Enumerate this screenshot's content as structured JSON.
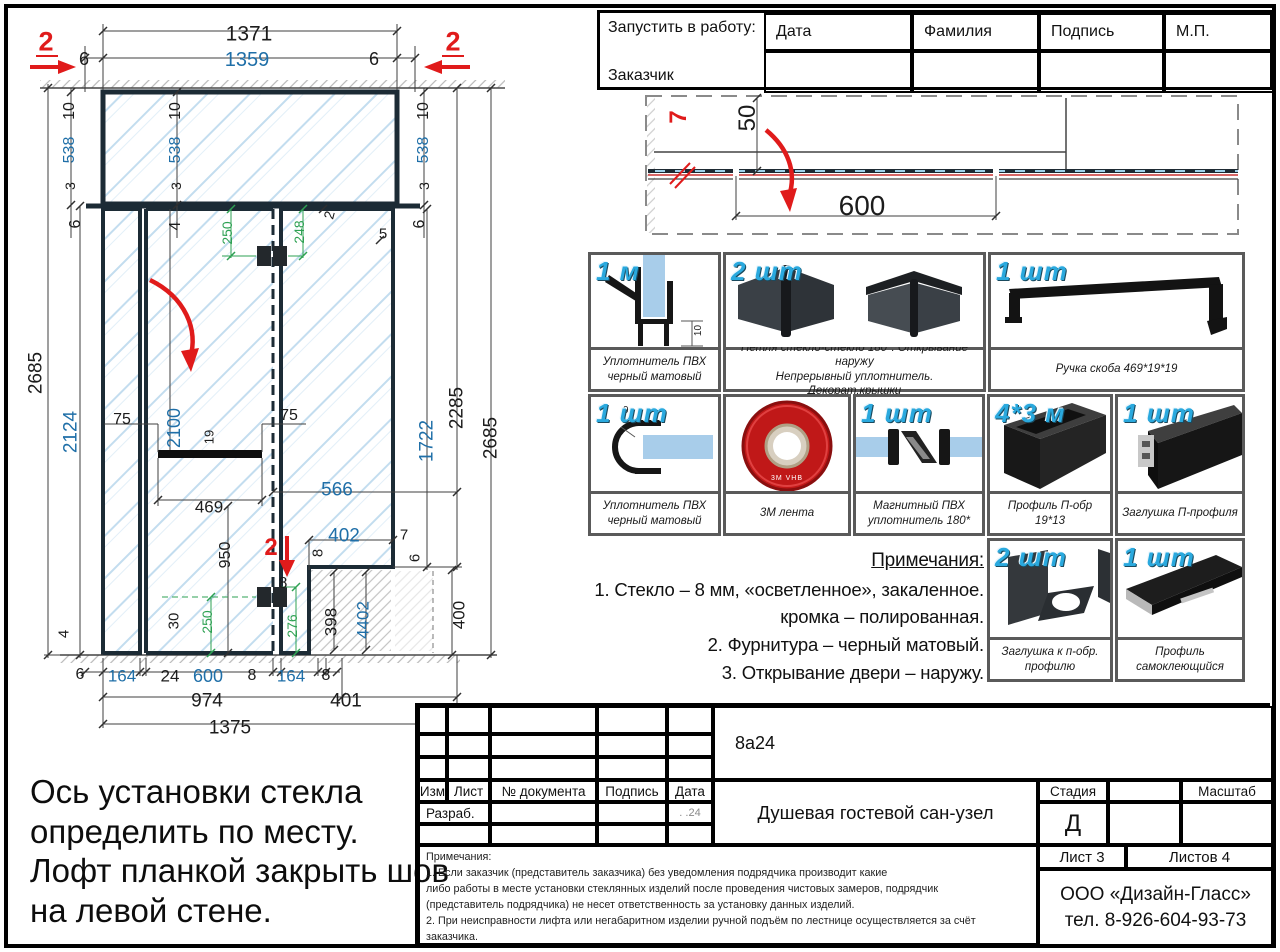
{
  "approval": {
    "request_label": "Запустить в работу:",
    "customer_label": "Заказчик",
    "col_date": "Дата",
    "col_name": "Фамилия",
    "col_sign": "Подпись",
    "col_stamp": "М.П."
  },
  "notes": {
    "title": "Примечания:",
    "line1": "1. Стекло – 8 мм, «осветленное», закаленное.",
    "line2": "кромка – полированная.",
    "line3": "2. Фурнитура – черный матовый.",
    "line4": "3. Открывание двери – наружу."
  },
  "install_note": {
    "line1": "Ось установки стекла",
    "line2": "определить по месту.",
    "line3": "Лофт планкой закрыть шов",
    "line4": "на левой стене."
  },
  "parts": {
    "items": [
      {
        "qty": "1 м",
        "cap1": "Уплотнитель ПВХ",
        "cap2": "черный матовый",
        "dim": "10"
      },
      {
        "qty": "2 шт",
        "cap1": "Петля стекло-стекло 180*. Открывание наружу",
        "cap2": "Непрерывный уплотнитель. Декорат.крышки"
      },
      {
        "qty": "1 шт",
        "cap1": "Ручка скоба 469*19*19",
        "cap2": ""
      },
      {
        "qty": "1 шт",
        "cap1": "Уплотнитель ПВХ",
        "cap2": "черный матовый",
        "dim": "9"
      },
      {
        "qty": "",
        "cap1": "3М лента",
        "cap2": "",
        "tape": "3M VHB"
      },
      {
        "qty": "1 шт",
        "cap1": "Магнитный ПВХ",
        "cap2": "уплотнитель 180*"
      },
      {
        "qty": "4*3 м",
        "cap1": "Профиль П-обр 19*13",
        "cap2": ""
      },
      {
        "qty": "1 шт",
        "cap1": "Заглушка П-профиля",
        "cap2": ""
      },
      {
        "qty": "2 шт",
        "cap1": "Заглушка к п-обр.",
        "cap2": "профилю"
      },
      {
        "qty": "1 шт",
        "cap1": "Профиль",
        "cap2": "самоклеющийся"
      }
    ]
  },
  "title_block": {
    "doc_code": "8а24",
    "col_izm": "Изм",
    "col_list": "Лист",
    "col_doc": "№ документа",
    "col_sign": "Подпись",
    "col_date": "Дата",
    "razrab": "Разраб.",
    "date_value": ".   .24",
    "project_title": "Душевая гостевой сан-узел",
    "stage_label": "Стадия",
    "stage_value": "Д",
    "scale_label": "Масштаб",
    "sheet": "Лист 3",
    "sheets": "Листов 4",
    "company": "ООО «Дизайн-Гласс»",
    "phone": "тел. 8-926-604-93-73",
    "fine_title": "Примечания:",
    "fine1": "1. Если заказчик (представитель заказчика) без уведомления подрядчика производит какие",
    "fine2": "либо работы в месте установки стеклянных изделий после проведения чистовых замеров, подрядчик",
    "fine3": "(представитель подрядчика) не несет ответственность за установку данных изделий.",
    "fine4": "2. При неисправности лифта или негабаритном изделии ручной подъём по лестнице осуществляется за счёт",
    "fine5": "заказчика."
  },
  "drawing": {
    "labels": [
      {
        "t": "1371",
        "x": 249,
        "y": 34,
        "s": 21
      },
      {
        "t": "6",
        "x": 84,
        "y": 59,
        "s": 18
      },
      {
        "t": "1359",
        "x": 247,
        "y": 60,
        "s": 20,
        "c": "b"
      },
      {
        "t": "6",
        "x": 374,
        "y": 59,
        "s": 18
      },
      {
        "t": "2",
        "x": 46,
        "y": 42,
        "s": 27,
        "c": "r"
      },
      {
        "t": "2",
        "x": 453,
        "y": 42,
        "s": 27,
        "c": "r"
      },
      {
        "t": "10",
        "x": 70,
        "y": 111,
        "s": 16,
        "r": -90
      },
      {
        "t": "538",
        "x": 70,
        "y": 150,
        "s": 16,
        "c": "b",
        "r": -90
      },
      {
        "t": "3",
        "x": 70,
        "y": 186,
        "s": 14,
        "r": -90
      },
      {
        "t": "6",
        "x": 76,
        "y": 224,
        "s": 16,
        "r": -90
      },
      {
        "t": "10",
        "x": 176,
        "y": 111,
        "s": 16,
        "r": -90
      },
      {
        "t": "538",
        "x": 176,
        "y": 150,
        "s": 16,
        "c": "b",
        "r": -90
      },
      {
        "t": "3",
        "x": 176,
        "y": 186,
        "s": 14,
        "r": -90
      },
      {
        "t": "4",
        "x": 176,
        "y": 226,
        "s": 16,
        "r": -90
      },
      {
        "t": "10",
        "x": 424,
        "y": 111,
        "s": 16,
        "r": -90
      },
      {
        "t": "538",
        "x": 424,
        "y": 150,
        "s": 16,
        "c": "b",
        "r": -90
      },
      {
        "t": "3",
        "x": 424,
        "y": 186,
        "s": 14,
        "r": -90
      },
      {
        "t": "6",
        "x": 420,
        "y": 224,
        "s": 16,
        "r": -90
      },
      {
        "t": "2",
        "x": 329,
        "y": 215,
        "s": 14,
        "r": -75
      },
      {
        "t": "5",
        "x": 383,
        "y": 234,
        "s": 15
      },
      {
        "t": "2685",
        "x": 36,
        "y": 373,
        "s": 19,
        "r": -90
      },
      {
        "t": "2124",
        "x": 71,
        "y": 432,
        "s": 19,
        "c": "b",
        "r": -90
      },
      {
        "t": "2100",
        "x": 174,
        "y": 428,
        "s": 18,
        "c": "b",
        "r": -90
      },
      {
        "t": "75",
        "x": 122,
        "y": 420,
        "s": 16
      },
      {
        "t": "75",
        "x": 289,
        "y": 416,
        "s": 16
      },
      {
        "t": "19",
        "x": 209,
        "y": 437,
        "s": 13,
        "r": -90
      },
      {
        "t": "469",
        "x": 209,
        "y": 507,
        "s": 17
      },
      {
        "t": "950",
        "x": 226,
        "y": 555,
        "s": 16,
        "r": -90
      },
      {
        "t": "566",
        "x": 337,
        "y": 490,
        "s": 19,
        "c": "b"
      },
      {
        "t": "402",
        "x": 344,
        "y": 536,
        "s": 19,
        "c": "b"
      },
      {
        "t": "7",
        "x": 404,
        "y": 535,
        "s": 15
      },
      {
        "t": "6",
        "x": 415,
        "y": 558,
        "s": 15,
        "r": -90
      },
      {
        "t": "2",
        "x": 271,
        "y": 548,
        "s": 24,
        "c": "r"
      },
      {
        "t": "8",
        "x": 283,
        "y": 584,
        "s": 16
      },
      {
        "t": "8",
        "x": 318,
        "y": 553,
        "s": 15,
        "r": -90
      },
      {
        "t": "398",
        "x": 331,
        "y": 622,
        "s": 17,
        "r": -90
      },
      {
        "t": "4402",
        "x": 363,
        "y": 620,
        "s": 17,
        "c": "b",
        "r": -90
      },
      {
        "t": "400",
        "x": 459,
        "y": 615,
        "s": 17,
        "r": -90
      },
      {
        "t": "1722",
        "x": 427,
        "y": 441,
        "s": 19,
        "c": "b",
        "r": -90
      },
      {
        "t": "2285",
        "x": 457,
        "y": 408,
        "s": 19,
        "r": -90
      },
      {
        "t": "2685",
        "x": 491,
        "y": 438,
        "s": 19,
        "r": -90
      },
      {
        "t": "250",
        "x": 227,
        "y": 233,
        "s": 14,
        "c": "g",
        "r": -90
      },
      {
        "t": "248",
        "x": 299,
        "y": 232,
        "s": 14,
        "c": "g",
        "r": -90
      },
      {
        "t": "250",
        "x": 207,
        "y": 622,
        "s": 14,
        "c": "g",
        "r": -90
      },
      {
        "t": "276",
        "x": 292,
        "y": 626,
        "s": 14,
        "c": "g",
        "r": -90
      },
      {
        "t": "30",
        "x": 174,
        "y": 621,
        "s": 15,
        "r": -90
      },
      {
        "t": "4",
        "x": 64,
        "y": 634,
        "s": 15,
        "r": -90
      },
      {
        "t": "6",
        "x": 80,
        "y": 675,
        "s": 16
      },
      {
        "t": "164",
        "x": 122,
        "y": 676,
        "s": 17,
        "c": "b"
      },
      {
        "t": "24",
        "x": 170,
        "y": 676,
        "s": 17
      },
      {
        "t": "600",
        "x": 208,
        "y": 676,
        "s": 18,
        "c": "b"
      },
      {
        "t": "8",
        "x": 252,
        "y": 676,
        "s": 16
      },
      {
        "t": "164",
        "x": 291,
        "y": 676,
        "s": 17,
        "c": "b"
      },
      {
        "t": "8",
        "x": 326,
        "y": 676,
        "s": 16
      },
      {
        "t": "974",
        "x": 207,
        "y": 701,
        "s": 19
      },
      {
        "t": "401",
        "x": 346,
        "y": 701,
        "s": 19
      },
      {
        "t": "1375",
        "x": 230,
        "y": 728,
        "s": 19
      },
      {
        "t": "50",
        "x": 748,
        "y": 118,
        "s": 24,
        "r": -90
      },
      {
        "t": "600",
        "x": 862,
        "y": 206,
        "s": 28
      },
      {
        "t": "7",
        "x": 679,
        "y": 117,
        "s": 24,
        "c": "r",
        "r": -90
      }
    ]
  }
}
